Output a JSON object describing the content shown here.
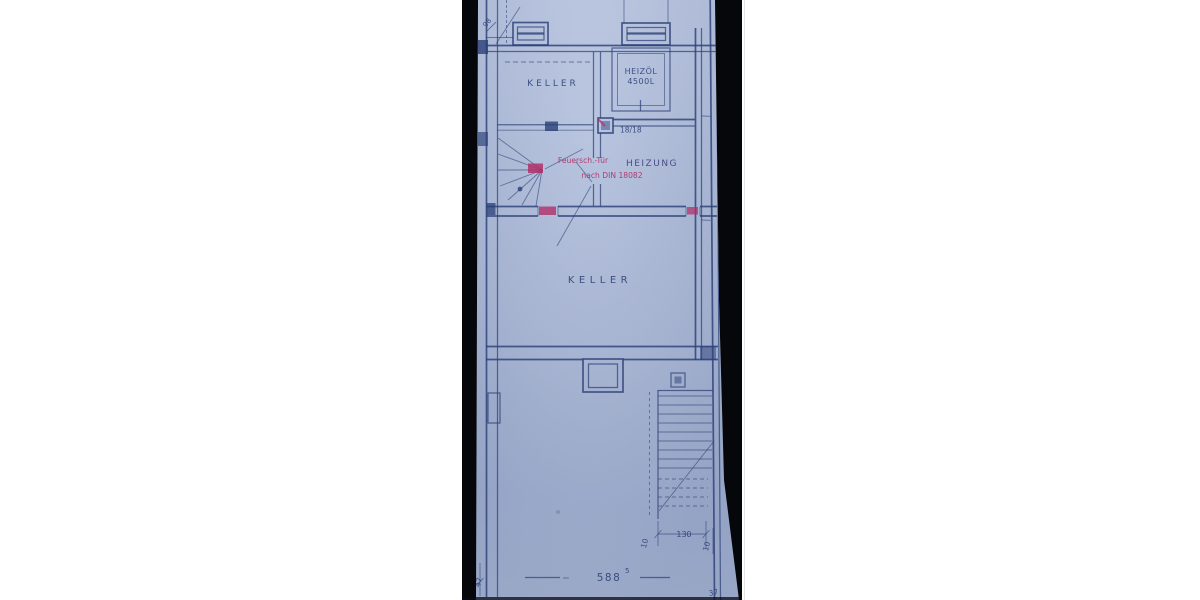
{
  "plan": {
    "rooms": {
      "keller_upper": {
        "label": "KELLER"
      },
      "heizoel": {
        "line1": "HEIZÖL",
        "line2": "4500L"
      },
      "heizung": {
        "label": "HEIZUNG"
      },
      "keller_main": {
        "label": "KELLER"
      }
    },
    "annotations": {
      "column_size": "18/18",
      "fire_note_line1": "Feuersch.-Tür",
      "fire_note_line2": "nach DIN 18082"
    },
    "dimensions": {
      "bottom_width": "588",
      "bottom_width_sup": "5",
      "stair_width": "130",
      "stair_side_left": "10",
      "stair_side_right": "10",
      "corner_left": "47",
      "corner_right": "37",
      "top_left_mark": "98"
    },
    "colors": {
      "photo_background": "#06070a",
      "paper": "#aab8d6",
      "ink": "#2b4077",
      "red_annotation": "#b13069",
      "heizung_ink": "#3a3e7e",
      "canvas": "#ffffff"
    }
  }
}
